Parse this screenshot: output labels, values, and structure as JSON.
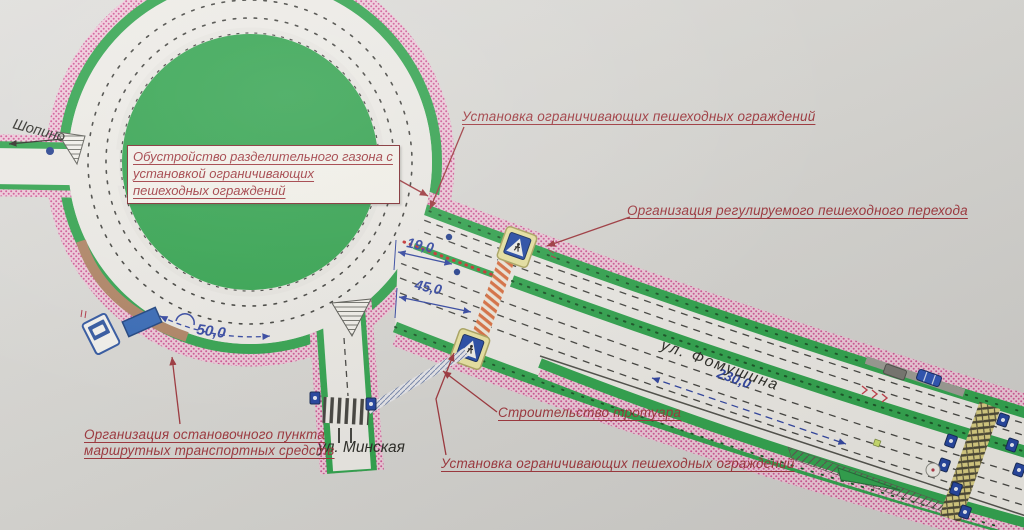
{
  "scheme": {
    "streets": {
      "shopino": "Шопино",
      "minskaya": "ул. Минская",
      "fomushina": "ул. Фомушина"
    },
    "dimensions": {
      "bus_bay": "50,0",
      "width_19": "19,0",
      "width_45": "45,0",
      "length_230": "230,0"
    },
    "annotations": {
      "median_box_line1": "Обустройство разделительного газона с",
      "median_box_line2": "установкой ограничивающих",
      "median_box_line3": "пешеходных ограждений",
      "fences_top": "Установка ограничивающих пешеходных ограждений",
      "regulated_crossing": "Организация регулируемого пешеходного перехода",
      "bus_stop_line1": "Организация остановочного пункта",
      "bus_stop_line2": "маршрутных транспортных средств",
      "sidewalk": "Строительство тротуара",
      "fences_bottom": "Установка ограничивающих пешеходных ограждений"
    },
    "colors": {
      "annotation_red": "#9c2f36",
      "dimension_blue": "#2a3f9f",
      "grass_green": "#2aa148",
      "hatch_pink": "#cf5292",
      "sign_blue": "#1c44a4",
      "sign_plate_yellow": "#eae49f"
    }
  }
}
